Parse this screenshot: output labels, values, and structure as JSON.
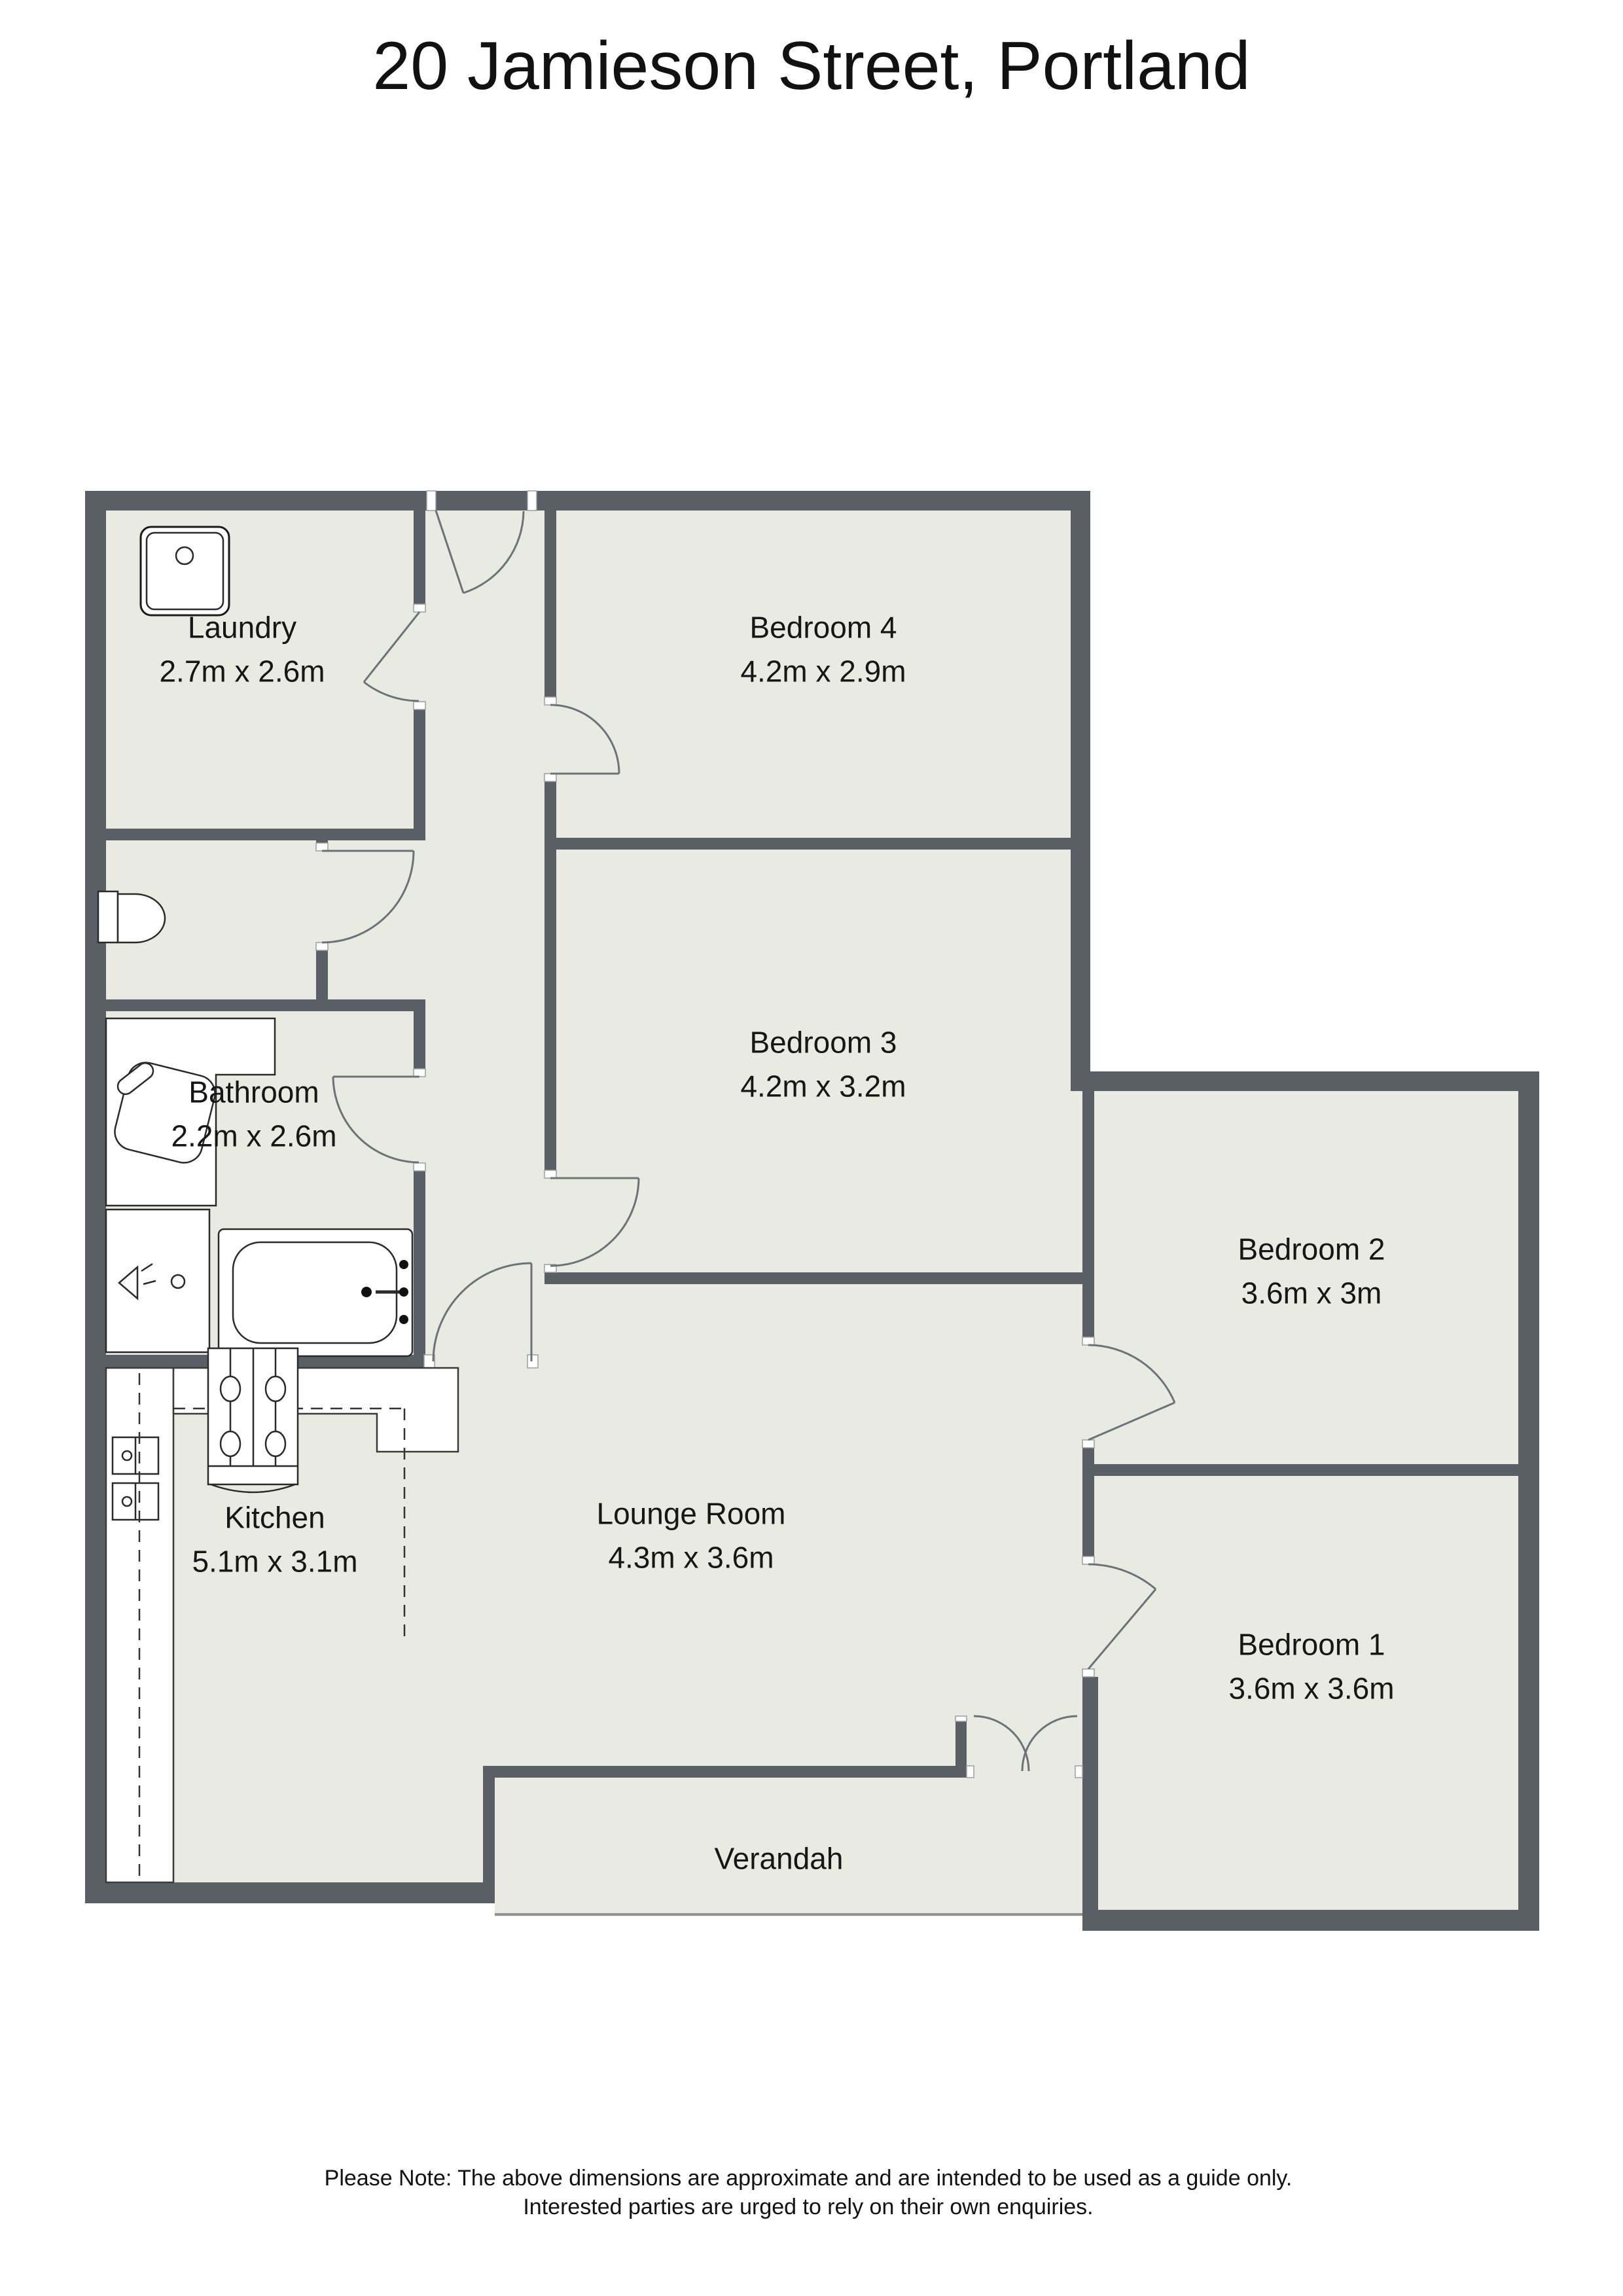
{
  "title": "20 Jamieson Street, Portland",
  "rooms": [
    {
      "name": "Laundry",
      "dims": "2.7m x 2.6m"
    },
    {
      "name": "Bedroom 4",
      "dims": "4.2m x 2.9m"
    },
    {
      "name": "Bedroom 3",
      "dims": "4.2m x 3.2m"
    },
    {
      "name": "Bathroom",
      "dims": "2.2m x 2.6m"
    },
    {
      "name": "Bedroom 2",
      "dims": "3.6m x 3m"
    },
    {
      "name": "Kitchen",
      "dims": "5.1m x 3.1m"
    },
    {
      "name": "Lounge Room",
      "dims": "4.3m x 3.6m"
    },
    {
      "name": "Bedroom 1",
      "dims": "3.6m x 3.6m"
    },
    {
      "name": "Verandah",
      "dims": ""
    }
  ],
  "footer": {
    "line1": "Please Note: The above dimensions are approximate and are intended to be used as a guide only.",
    "line2": "Interested parties are urged to rely on their own enquiries."
  },
  "colors": {
    "wall": "#5a5e65",
    "floor": "#e9eae2",
    "door_line": "#6e7277",
    "text": "#1a1a1a"
  },
  "fixtures": [
    "laundry-sink",
    "toilet",
    "vanity-basin",
    "shower",
    "bathtub",
    "stove",
    "kitchen-cabinets"
  ]
}
